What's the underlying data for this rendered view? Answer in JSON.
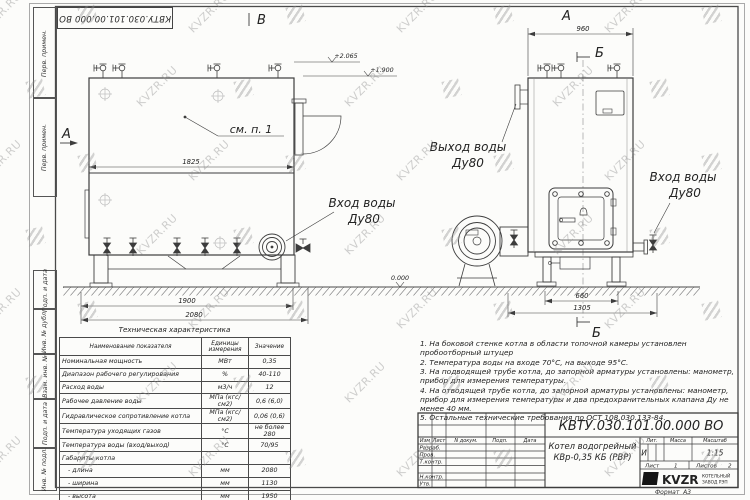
{
  "sheet": {
    "doc_number": "КВТУ.030.101.00.000 ВО",
    "watermark_text": "KVZR.RU",
    "format_label": "Формат",
    "format_value": "А3"
  },
  "margin_labels": [
    "Перв. примен.",
    "Перв. примен.",
    "Подп. и дата",
    "Инв. № дубл.",
    "Взам. инв. №",
    "Подп. и дата",
    "Инв. № подл."
  ],
  "drawing": {
    "view_b_label": "В",
    "view_a_side_label": "А",
    "view_a_top_label": "А",
    "section_label_top": "Б",
    "section_label_bottom": "Б",
    "callout_see_item": "см. п. 1",
    "dims": {
      "front_top_width": "1825",
      "front_base": "1900",
      "front_overall": "2080",
      "side_top_width": "960",
      "side_base": "660",
      "side_overall": "1305"
    },
    "elevations": {
      "e1": "+2.065",
      "e2": "+1.900",
      "zero": "0.000"
    },
    "labels": {
      "inlet_front_1": "Вход воды",
      "inlet_front_2": "Ду80",
      "outlet_side_1": "Выход воды",
      "outlet_side_2": "Ду80",
      "inlet_side_1": "Вход воды",
      "inlet_side_2": "Ду80"
    }
  },
  "spec_table": {
    "title": "Техническая характеристика",
    "headers": [
      "Наименование показателя",
      "Единицы измерения",
      "Значение"
    ],
    "rows": [
      [
        "Номинальная мощность",
        "МВт",
        "0,35"
      ],
      [
        "Диапазон рабочего регулирования",
        "%",
        "40-110"
      ],
      [
        "Расход воды",
        "м3/ч",
        "12"
      ],
      [
        "Рабочее давление воды",
        "МПа (кгс/см2)",
        "0,6 (6,0)"
      ],
      [
        "Гидравлическое сопротивление котла",
        "МПа (кгс/см2)",
        "0,06 (0,6)"
      ],
      [
        "Температура уходящих газов",
        "°С",
        "не более 280"
      ],
      [
        "Температура воды (вход/выход)",
        "°С",
        "70/95"
      ],
      [
        "Габариты котла",
        "",
        ""
      ],
      [
        "   - длина",
        "мм",
        "2080"
      ],
      [
        "   - ширина",
        "мм",
        "1130"
      ],
      [
        "   - высота",
        "мм",
        "1950"
      ]
    ]
  },
  "notes": [
    "1. На боковой стенке котла в области топочной камеры установлен пробоотборный штуцер",
    "2. Температура воды на входе 70°С, на выходе 95°С.",
    "3. На подводящей трубе котла, до запорной арматуры установлены: манометр, прибор для измерения температуры.",
    "4. На отводящей трубе котла, до запорной арматуры установлены: манометр, прибор для измерения температуры и два предохранительных клапана Ду не менее 40 мм.",
    "5. Остальные технические требования по ОСТ 108.030.133-84."
  ],
  "title_block": {
    "header_row": [
      "Изм",
      "Лист",
      "N докум.",
      "Подп.",
      "Дата"
    ],
    "left_rows": [
      "Разраб.",
      "Пров.",
      "Т.контр.",
      "Н.контр.",
      "Утв."
    ],
    "product_name_line1": "Котел водогрейный",
    "product_name_line2": "КВр-0,35 КБ (РВР)",
    "lit_header": "Лит.",
    "mass_header": "Масса",
    "scale_header": "Масштаб",
    "lit_value": "И",
    "scale_value": "1:15",
    "sheet_label": "Лист",
    "sheet_value": "1",
    "sheets_label": "Листов",
    "sheets_value": "2",
    "company_name": "KVZR",
    "company_line1": "КОТЕЛЬНЫЙ",
    "company_line2": "ЗАВОД РЭП"
  }
}
